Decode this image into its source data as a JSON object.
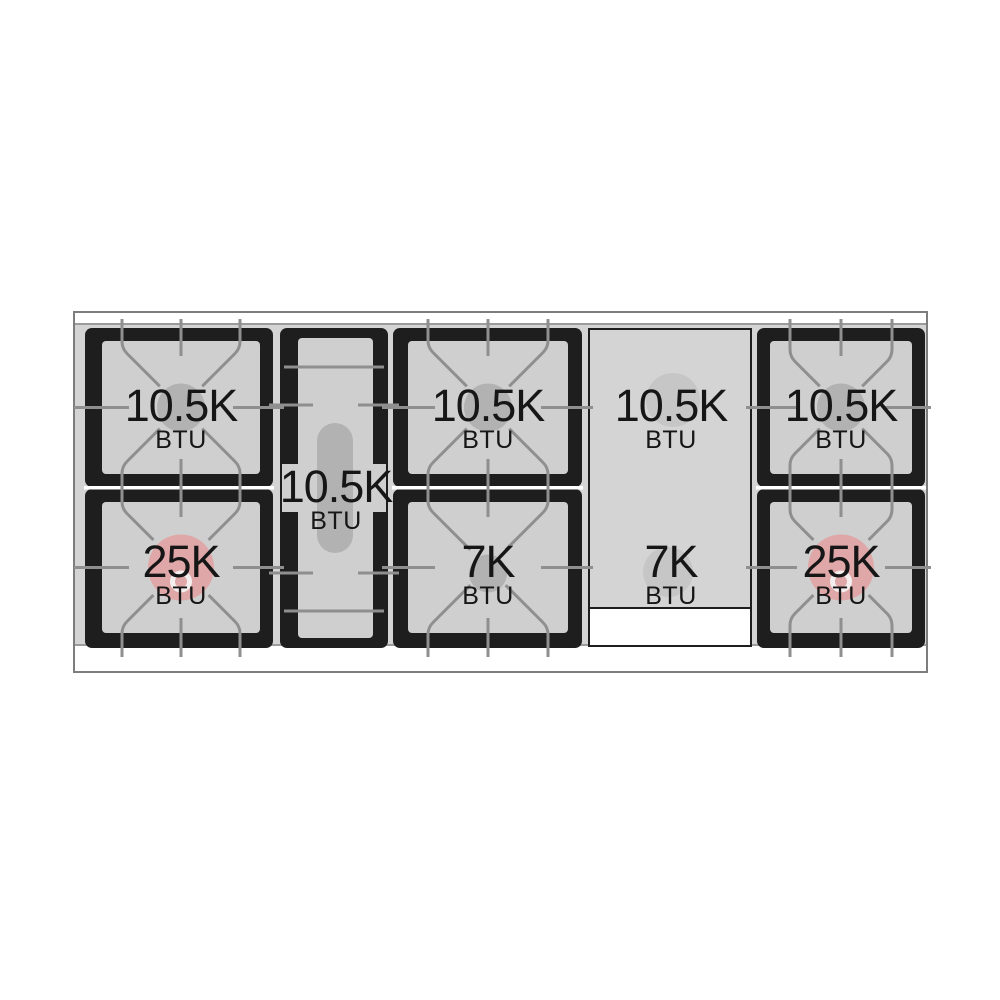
{
  "colors": {
    "page_bg": "#ffffff",
    "surface": "#d4d4d4",
    "window_fill": "#cfcfcf",
    "frame": "#1e1e1e",
    "grate_line": "#8f8f8f",
    "burner_gray": "#b2b2b2",
    "burner_pink": "#dfa7a7",
    "burner_pink_ring": "#f5eeee",
    "griddle_circle": "#c6c6c6",
    "seam": "#ffffff",
    "outline": "#7d7d7d",
    "trim_line": "#9b9b9b",
    "text": "#161616"
  },
  "burners": [
    {
      "id": "left-top",
      "value": "10.5K",
      "unit": "BTU"
    },
    {
      "id": "left-bottom",
      "value": "25K",
      "unit": "BTU"
    },
    {
      "id": "center-oval",
      "value": "10.5K",
      "unit": "BTU"
    },
    {
      "id": "middle-top",
      "value": "10.5K",
      "unit": "BTU"
    },
    {
      "id": "middle-bottom",
      "value": "7K",
      "unit": "BTU"
    },
    {
      "id": "griddle-top",
      "value": "10.5K",
      "unit": "BTU"
    },
    {
      "id": "griddle-bottom",
      "value": "7K",
      "unit": "BTU"
    },
    {
      "id": "right-top",
      "value": "10.5K",
      "unit": "BTU"
    },
    {
      "id": "right-bottom",
      "value": "25K",
      "unit": "BTU"
    }
  ]
}
